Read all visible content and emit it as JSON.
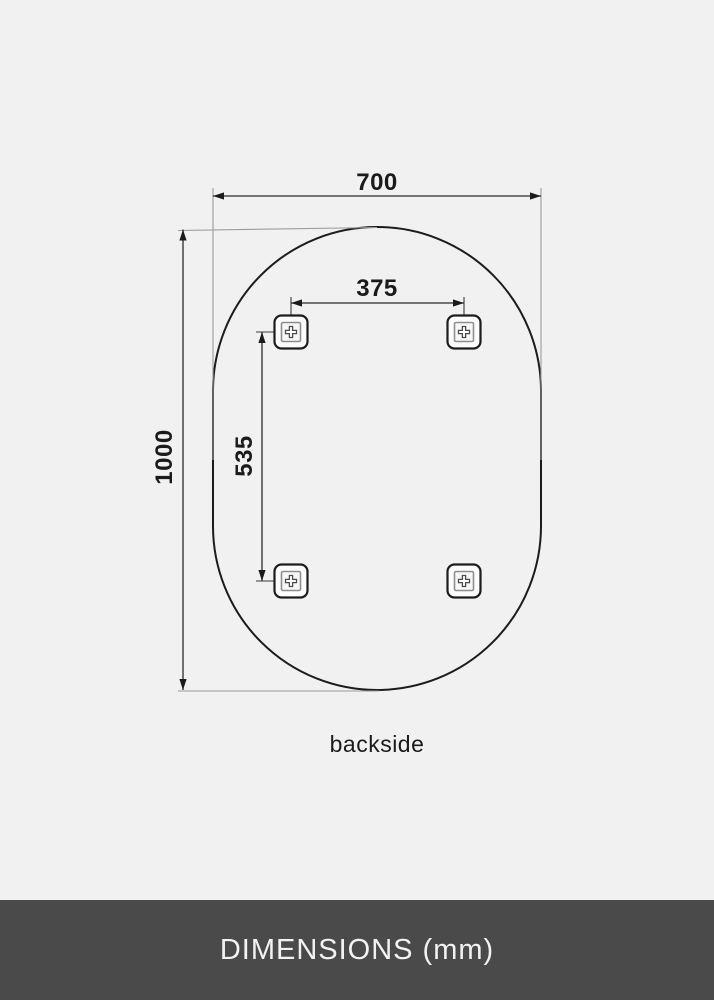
{
  "diagram": {
    "type": "technical-dimension-drawing",
    "subject": "oval mirror, backside view with mounting brackets",
    "unit": "mm",
    "width_label": "700",
    "height_label": "1000",
    "bracket_spacing_horizontal_label": "375",
    "bracket_spacing_vertical_label": "535",
    "view_label": "backside",
    "bracket_count": 4
  },
  "icons": {
    "mount_bracket": "square-mount-bracket-with-cross-screw"
  },
  "footer": {
    "title": "DIMENSIONS (mm)"
  },
  "colors": {
    "background": "#f1f1f1",
    "outline": "#1c1c1c",
    "dimension_line": "#2b2b2b",
    "extension_line": "#9b9b9b",
    "label_text": "#1b1b1b",
    "footer_background": "#4a4a4a",
    "footer_text": "#f2f2f2"
  }
}
